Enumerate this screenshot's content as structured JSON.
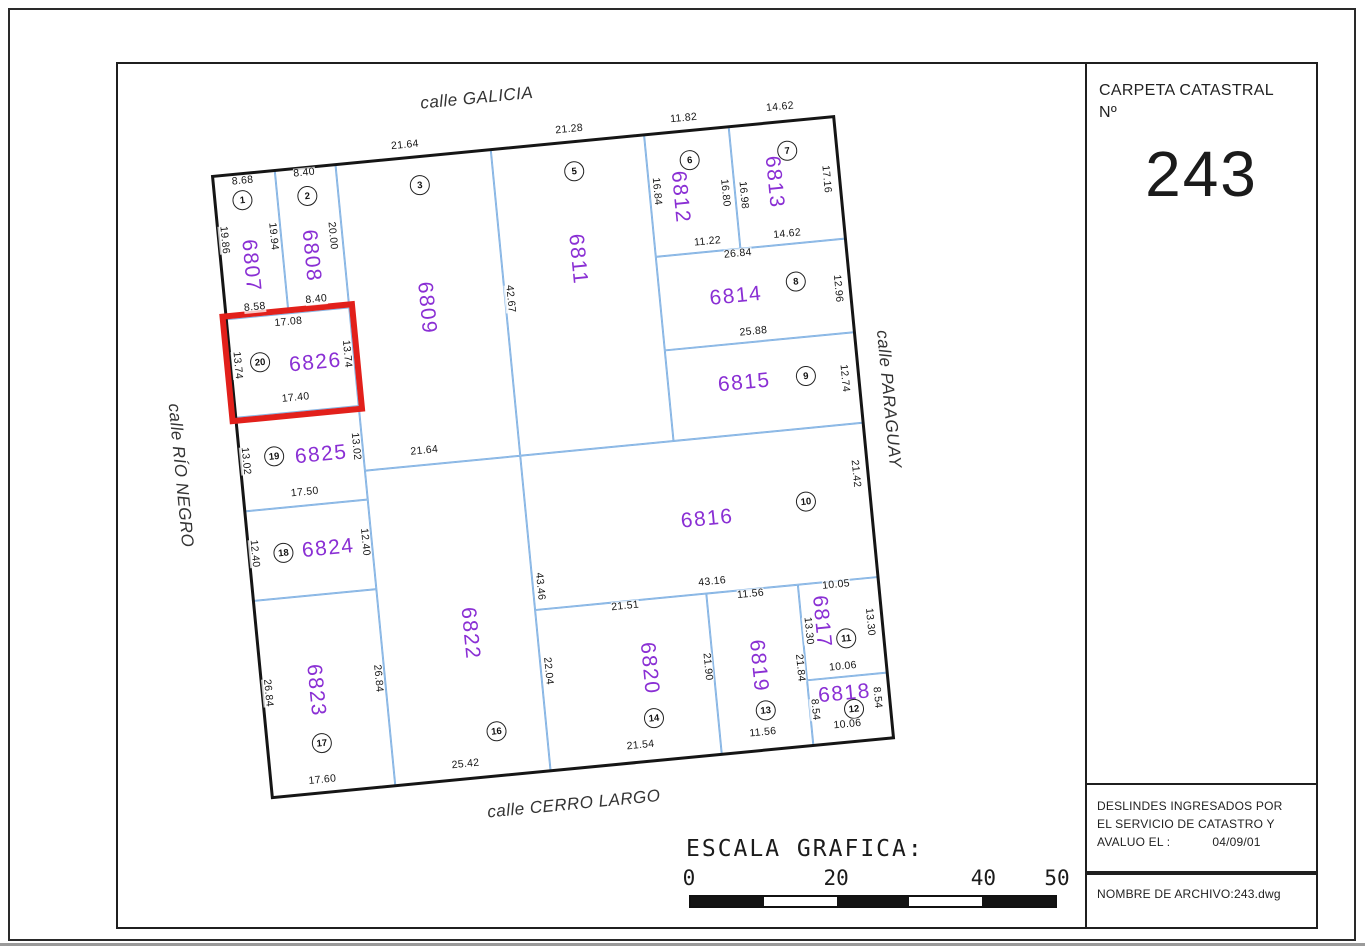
{
  "carpeta": {
    "label_line1": "CARPETA CATASTRAL",
    "label_line2": "Nº",
    "number": "243"
  },
  "deslindes": {
    "lines": [
      "DESLINDES INGRESADOS POR",
      "EL SERVICIO DE CATASTRO Y"
    ],
    "label": "AVALUO EL :",
    "date": "04/09/01"
  },
  "archivo": {
    "text": "NOMBRE DE ARCHIVO:243.dwg"
  },
  "scale_bar": {
    "title": "ESCALA GRAFICA:",
    "ticks": [
      {
        "label": "0",
        "pos": 0
      },
      {
        "label": "20",
        "pos": 0.4
      },
      {
        "label": "40",
        "pos": 0.8
      },
      {
        "label": "50",
        "pos": 1.0
      }
    ],
    "segments": [
      "dark",
      "light",
      "dark",
      "light",
      "dark"
    ]
  },
  "map": {
    "rotation_deg": -5.5,
    "colors": {
      "parcel_line": "#85b4e4",
      "parcel_number": "#8a2fd4",
      "highlight": "#e2201b",
      "ink": "#1c1c1c"
    },
    "streets": [
      {
        "key": "galicia",
        "name": "calle GALICIA",
        "x": 271,
        "y": -52,
        "rot": 0
      },
      {
        "key": "cerro-largo",
        "name": "calle CERRO LARGO",
        "x": 300,
        "y": 660,
        "rot": 0
      },
      {
        "key": "paraguay",
        "name": "calle PARAGUAY",
        "x": 652,
        "y": 287,
        "rot": 90
      },
      {
        "key": "rio-negro",
        "name": "calle RÍO NEGRO",
        "x": -60,
        "y": 295,
        "rot": 90
      }
    ],
    "parcels": [
      {
        "id": "6807",
        "lot": "1",
        "x": 0,
        "y": 0,
        "w": 63,
        "h": 144,
        "num": [
          30,
          93,
          90
        ],
        "lot_pos": [
          28,
          27
        ],
        "highlighted": false
      },
      {
        "id": "6808",
        "lot": "2",
        "x": 63,
        "y": 0,
        "w": 61,
        "h": 144,
        "num": [
          91,
          89,
          90
        ],
        "lot_pos": [
          93,
          29
        ],
        "highlighted": false
      },
      {
        "id": "6809",
        "lot": "3",
        "x": 124,
        "y": 0,
        "w": 156,
        "h": 308,
        "num": [
          201,
          152,
          90
        ],
        "lot_pos": [
          206,
          29
        ],
        "highlighted": false
      },
      {
        "id": "6811",
        "lot": "5",
        "x": 280,
        "y": 0,
        "w": 154,
        "h": 308,
        "num": [
          356,
          118,
          90
        ],
        "lot_pos": [
          361,
          30
        ],
        "highlighted": false
      },
      {
        "id": "6812",
        "lot": "6",
        "x": 434,
        "y": 0,
        "w": 85,
        "h": 123,
        "num": [
          464,
          66,
          90
        ],
        "lot_pos": [
          477,
          30
        ],
        "highlighted": false
      },
      {
        "id": "6813",
        "lot": "7",
        "x": 519,
        "y": 0,
        "w": 106,
        "h": 123,
        "num": [
          559,
          60,
          90
        ],
        "lot_pos": [
          575,
          30
        ],
        "highlighted": false
      },
      {
        "id": "6814",
        "lot": "8",
        "x": 434,
        "y": 123,
        "w": 191,
        "h": 94,
        "num": [
          510,
          170,
          0
        ],
        "lot_pos": [
          571,
          161
        ],
        "highlighted": false
      },
      {
        "id": "6815",
        "lot": "9",
        "x": 434,
        "y": 217,
        "w": 191,
        "h": 91,
        "num": [
          510,
          257,
          0
        ],
        "lot_pos": [
          572,
          256
        ],
        "highlighted": false
      },
      {
        "id": "6816",
        "lot": "10",
        "x": 280,
        "y": 308,
        "w": 345,
        "h": 155,
        "num": [
          460,
          389,
          0
        ],
        "lot_pos": [
          560,
          381
        ],
        "highlighted": false
      },
      {
        "id": "6817",
        "lot": "11",
        "x": 544,
        "y": 463,
        "w": 81,
        "h": 96,
        "num": [
          564,
          502,
          90
        ],
        "lot_pos": [
          587,
          521
        ],
        "highlighted": false
      },
      {
        "id": "6818",
        "lot": "12",
        "x": 544,
        "y": 559,
        "w": 81,
        "h": 66,
        "num": [
          580,
          576,
          0
        ],
        "lot_pos": [
          588,
          592
        ],
        "highlighted": false
      },
      {
        "id": "6819",
        "lot": "13",
        "x": 452,
        "y": 463,
        "w": 92,
        "h": 162,
        "num": [
          497,
          540,
          90
        ],
        "lot_pos": [
          500,
          585
        ],
        "highlighted": false
      },
      {
        "id": "6820",
        "lot": "14",
        "x": 280,
        "y": 463,
        "w": 172,
        "h": 162,
        "num": [
          388,
          532,
          90
        ],
        "lot_pos": [
          388,
          582
        ],
        "highlighted": false
      },
      {
        "id": "6822",
        "lot": "16",
        "x": 124,
        "y": 308,
        "w": 156,
        "h": 317,
        "num": [
          213,
          480,
          90
        ],
        "lot_pos": [
          230,
          580
        ],
        "highlighted": false
      },
      {
        "id": "6823",
        "lot": "17",
        "x": 0,
        "y": 427,
        "w": 124,
        "h": 198,
        "num": [
          54,
          522,
          90
        ],
        "lot_pos": [
          55,
          575
        ],
        "highlighted": false
      },
      {
        "id": "6824",
        "lot": "18",
        "x": 0,
        "y": 337,
        "w": 124,
        "h": 90,
        "num": [
          80,
          382,
          0
        ],
        "lot_pos": [
          35,
          382
        ],
        "highlighted": false
      },
      {
        "id": "6825",
        "lot": "19",
        "x": 0,
        "y": 243,
        "w": 124,
        "h": 94,
        "num": [
          82,
          288,
          0
        ],
        "lot_pos": [
          35,
          285
        ],
        "highlighted": false
      },
      {
        "id": "6826",
        "lot": "20",
        "x": 0,
        "y": 144,
        "w": 124,
        "h": 99,
        "num": [
          85,
          196,
          0
        ],
        "lot_pos": [
          30,
          190
        ],
        "highlighted": true
      }
    ],
    "dim_labels": [
      {
        "t": "8.68",
        "x": 30,
        "y": 8,
        "r": 0
      },
      {
        "t": "8.40",
        "x": 92,
        "y": 6,
        "r": 0
      },
      {
        "t": "21.64",
        "x": 195,
        "y": -12,
        "r": 0
      },
      {
        "t": "21.28",
        "x": 360,
        "y": -12,
        "r": 0
      },
      {
        "t": "11.82",
        "x": 475,
        "y": -12,
        "r": 0
      },
      {
        "t": "14.62",
        "x": 572,
        "y": -14,
        "r": 0
      },
      {
        "t": "19.86",
        "x": 6,
        "y": 65,
        "r": 90
      },
      {
        "t": "19.94",
        "x": 55,
        "y": 66,
        "r": 90
      },
      {
        "t": "20.00",
        "x": 114,
        "y": 71,
        "r": 90
      },
      {
        "t": "16.84",
        "x": 441,
        "y": 58,
        "r": 90
      },
      {
        "t": "16.80",
        "x": 509,
        "y": 66,
        "r": 90
      },
      {
        "t": "16.98",
        "x": 527,
        "y": 70,
        "r": 90
      },
      {
        "t": "17.16",
        "x": 611,
        "y": 62,
        "r": 90
      },
      {
        "t": "8.58",
        "x": 30,
        "y": 135,
        "r": 0
      },
      {
        "t": "8.40",
        "x": 92,
        "y": 133,
        "r": 0
      },
      {
        "t": "11.22",
        "x": 487,
        "y": 113,
        "r": 0
      },
      {
        "t": "14.62",
        "x": 567,
        "y": 113,
        "r": 0
      },
      {
        "t": "26.84",
        "x": 516,
        "y": 128,
        "r": 0
      },
      {
        "t": "12.96",
        "x": 612,
        "y": 172,
        "r": 90
      },
      {
        "t": "25.88",
        "x": 524,
        "y": 207,
        "r": 0
      },
      {
        "t": "12.74",
        "x": 610,
        "y": 262,
        "r": 90
      },
      {
        "t": "17.08",
        "x": 62,
        "y": 153,
        "r": 0
      },
      {
        "t": "13.74",
        "x": 7,
        "y": 191,
        "r": 90
      },
      {
        "t": "13.74",
        "x": 117,
        "y": 190,
        "r": 90
      },
      {
        "t": "17.40",
        "x": 62,
        "y": 229,
        "r": 0
      },
      {
        "t": "42.67",
        "x": 285,
        "y": 151,
        "r": 90
      },
      {
        "t": "13.02",
        "x": 6,
        "y": 287,
        "r": 90
      },
      {
        "t": "13.02",
        "x": 117,
        "y": 283,
        "r": 90
      },
      {
        "t": "17.50",
        "x": 62,
        "y": 324,
        "r": 0
      },
      {
        "t": "21.64",
        "x": 185,
        "y": 294,
        "r": 0
      },
      {
        "t": "21.42",
        "x": 612,
        "y": 358,
        "r": 90
      },
      {
        "t": "12.40",
        "x": 6,
        "y": 380,
        "r": 90
      },
      {
        "t": "12.40",
        "x": 117,
        "y": 379,
        "r": 90
      },
      {
        "t": "26.84",
        "x": 6,
        "y": 520,
        "r": 90
      },
      {
        "t": "26.84",
        "x": 117,
        "y": 516,
        "r": 90
      },
      {
        "t": "43.16",
        "x": 459,
        "y": 452,
        "r": 0
      },
      {
        "t": "21.51",
        "x": 370,
        "y": 468,
        "r": 0
      },
      {
        "t": "11.56",
        "x": 496,
        "y": 468,
        "r": 0
      },
      {
        "t": "10.05",
        "x": 582,
        "y": 467,
        "r": 0
      },
      {
        "t": "43.46",
        "x": 287,
        "y": 440,
        "r": 90
      },
      {
        "t": "22.04",
        "x": 287,
        "y": 525,
        "r": 90
      },
      {
        "t": "21.90",
        "x": 446,
        "y": 536,
        "r": 90
      },
      {
        "t": "21.84",
        "x": 538,
        "y": 546,
        "r": 90
      },
      {
        "t": "13.30",
        "x": 550,
        "y": 510,
        "r": 90
      },
      {
        "t": "13.30",
        "x": 612,
        "y": 507,
        "r": 90
      },
      {
        "t": "10.06",
        "x": 581,
        "y": 549,
        "r": 0
      },
      {
        "t": "8.54",
        "x": 549,
        "y": 589,
        "r": 90
      },
      {
        "t": "8.54",
        "x": 612,
        "y": 583,
        "r": 90
      },
      {
        "t": "10.06",
        "x": 580,
        "y": 607,
        "r": 0
      },
      {
        "t": "11.56",
        "x": 495,
        "y": 607,
        "r": 0
      },
      {
        "t": "21.54",
        "x": 372,
        "y": 608,
        "r": 0
      },
      {
        "t": "25.42",
        "x": 196,
        "y": 610,
        "r": 0
      },
      {
        "t": "17.60",
        "x": 52,
        "y": 612,
        "r": 0
      }
    ]
  }
}
